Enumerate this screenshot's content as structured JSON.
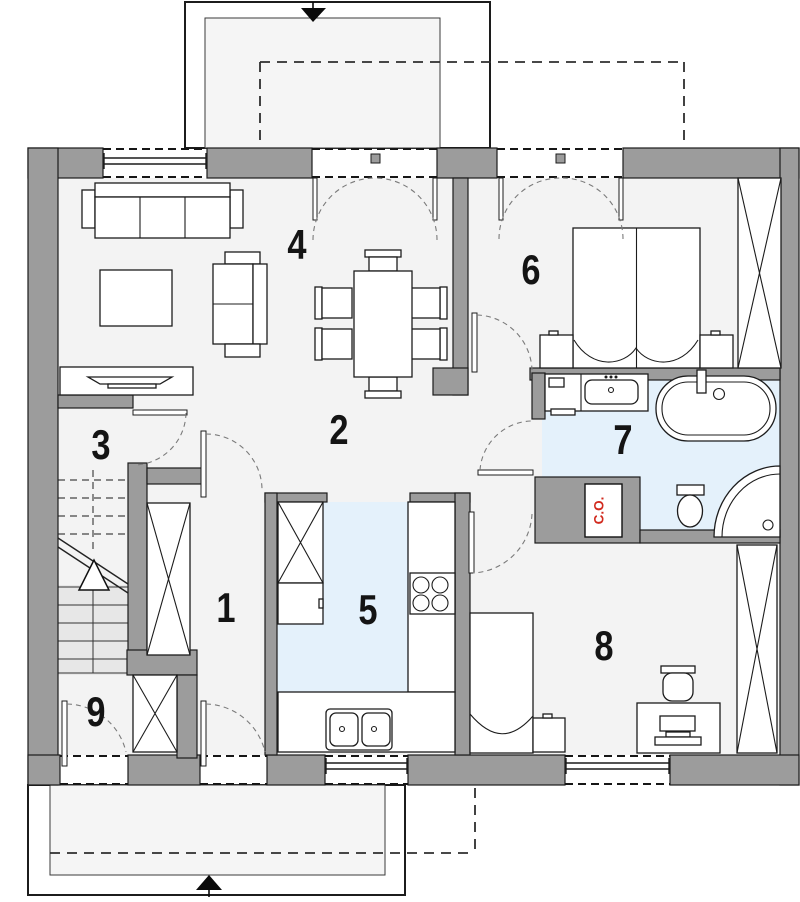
{
  "plan": {
    "room_labels": [
      "1",
      "2",
      "3",
      "4",
      "5",
      "6",
      "7",
      "8",
      "9"
    ],
    "heating_label": "C.O.",
    "colors": {
      "wall": "#9c9c9c",
      "floor": "#f3f3f3",
      "wet_floor": "#e4f1fb",
      "outline": "#1c1c1c",
      "heating_text": "#d12a1e"
    }
  }
}
